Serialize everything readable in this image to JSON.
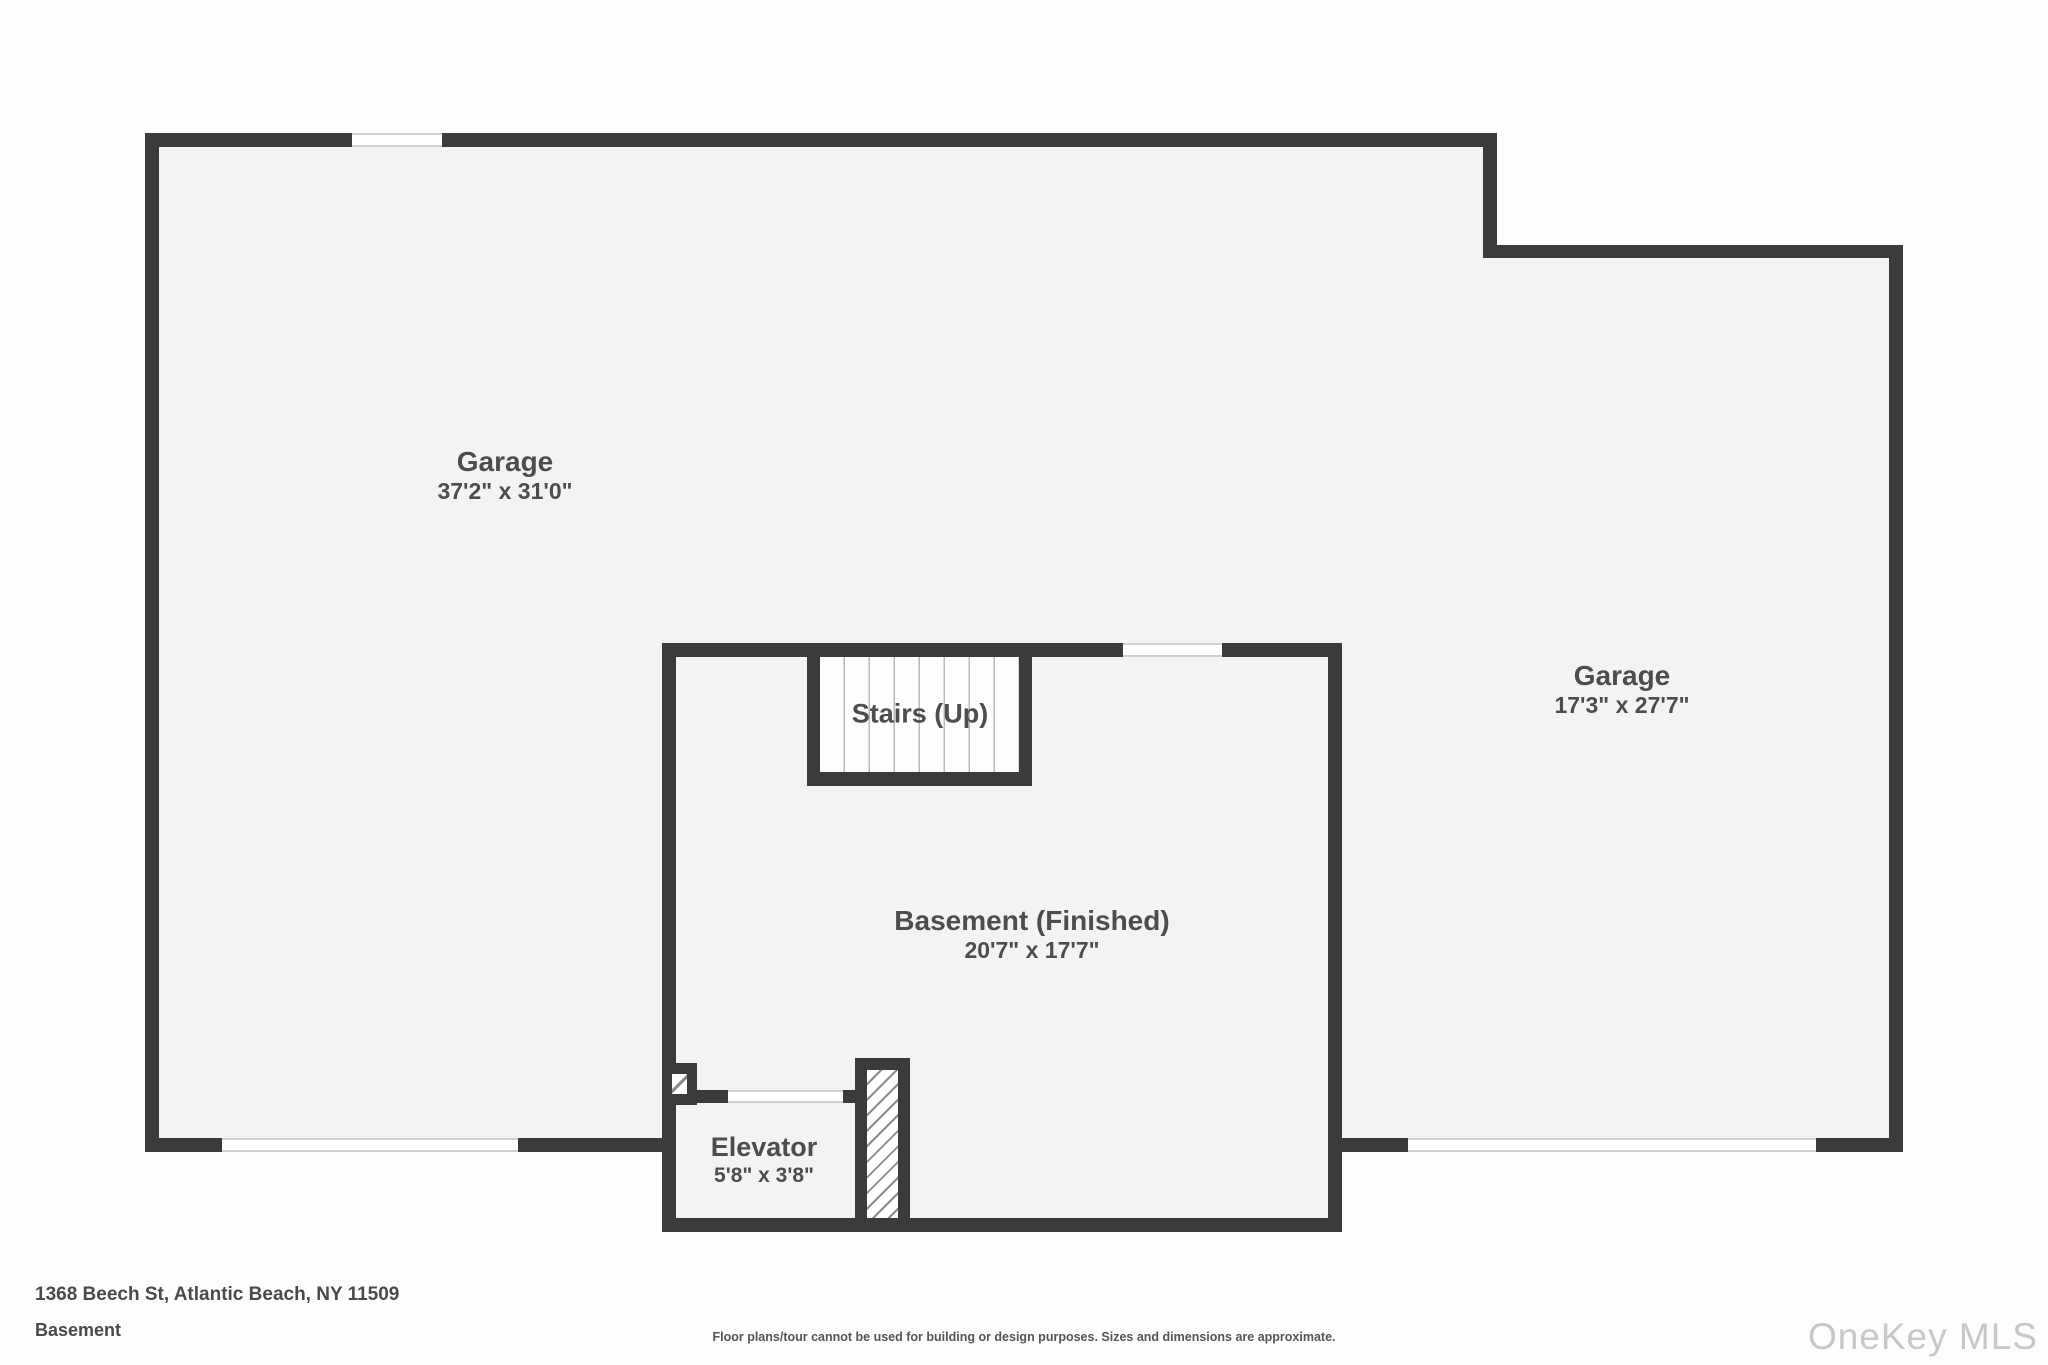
{
  "plan": {
    "type": "floorplan",
    "rooms": {
      "garage_left": {
        "label": "Garage",
        "dims": "37'2\" x 31'0\""
      },
      "garage_right": {
        "label": "Garage",
        "dims": "17'3\" x 27'7\""
      },
      "basement": {
        "label": "Basement (Finished)",
        "dims": "20'7\" x 17'7\""
      },
      "stairs": {
        "label": "Stairs (Up)"
      },
      "elevator": {
        "label": "Elevator",
        "dims": "5'8\" x 3'8\""
      }
    }
  },
  "footer": {
    "address": "1368 Beech St, Atlantic Beach, NY 11509",
    "floor_name": "Basement",
    "disclaimer": "Floor plans/tour cannot be used for building or design purposes. Sizes and dimensions are approximate.",
    "watermark": "OneKey MLS"
  },
  "colors": {
    "wall": "#3b3b3b",
    "floor": "#f4f3f3",
    "background": "#fdfdfd",
    "window_line": "#cfcfcf",
    "label_text": "#4d4d4d",
    "watermark_text": "#c7c7c7"
  }
}
